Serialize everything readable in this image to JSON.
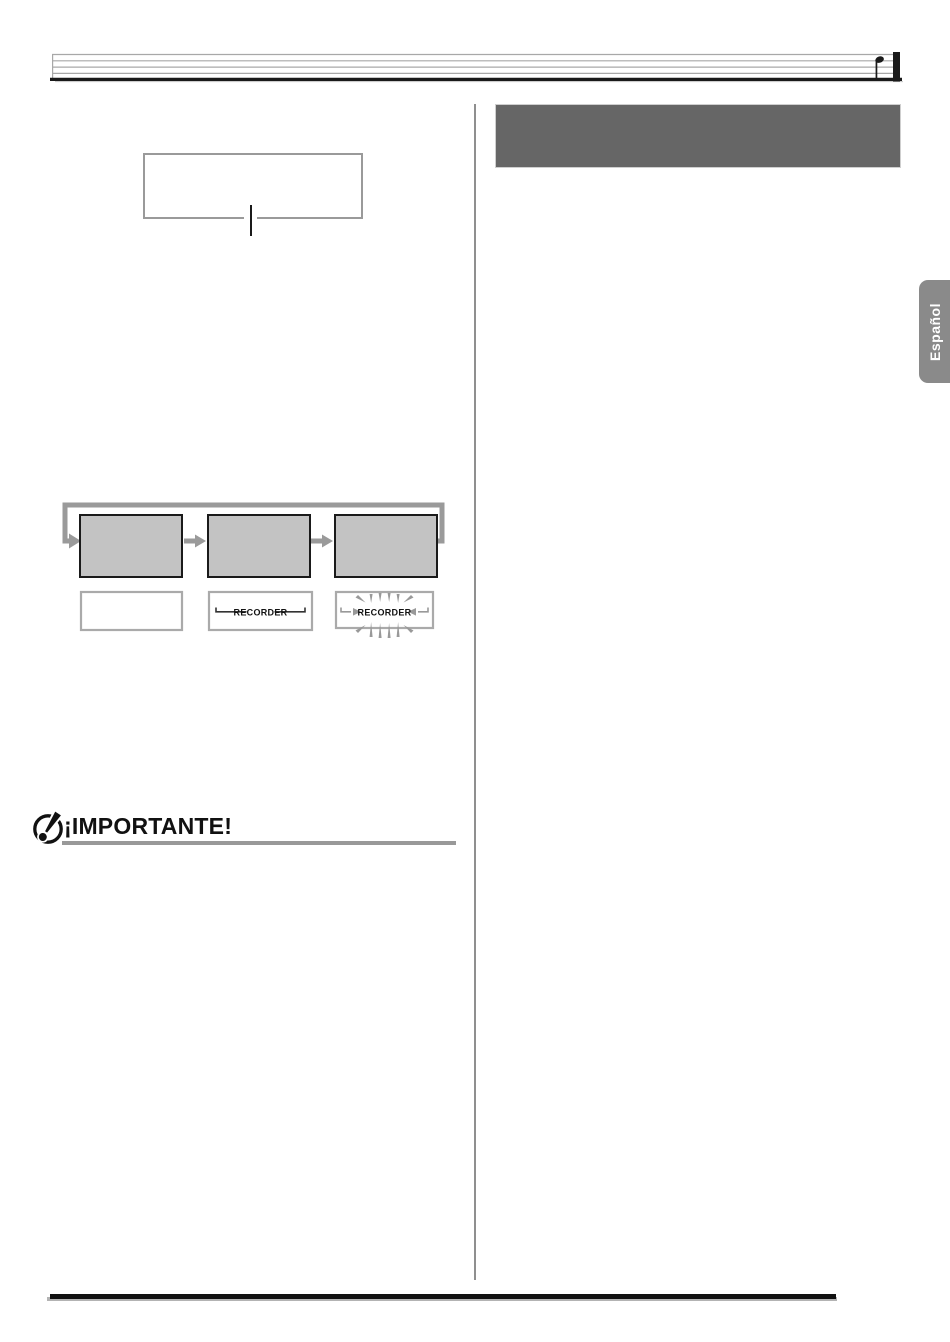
{
  "page": {
    "width": 950,
    "height": 1342,
    "background": "#ffffff"
  },
  "header": {
    "decoration": "musical-staff",
    "note_icon": "quarter-note",
    "staff_line_color": "#a8a8a8",
    "bar_color": "#1a1a1a"
  },
  "language_tab": {
    "label": "Español",
    "background": "#8a8a8a",
    "text_color": "#ffffff"
  },
  "left_column": {
    "callout_box": {
      "content": "",
      "border_color": "#9a9a9a"
    },
    "cycle_diagram": {
      "loop_color": "#9a9a9a",
      "step_box_fill": "#c3c3c3",
      "step_box_border": "#1a1a1a",
      "indicator_box_border": "#aaaaaa",
      "steps": [
        {
          "box_label": "",
          "indicator_label": "",
          "indicator_state": "off"
        },
        {
          "box_label": "",
          "indicator_label": "RECORDER",
          "indicator_state": "lit"
        },
        {
          "box_label": "",
          "indicator_label": "RECORDER",
          "indicator_state": "flashing"
        }
      ]
    },
    "important": {
      "heading": "¡IMPORTANTE!",
      "icon": "exclamation-circle",
      "rule_color": "#999999"
    }
  },
  "right_column": {
    "section_header_box": {
      "content": "",
      "background": "#666666"
    }
  },
  "divider_color": "#8f8f8f",
  "footer": {
    "rule_color": "#111111"
  }
}
